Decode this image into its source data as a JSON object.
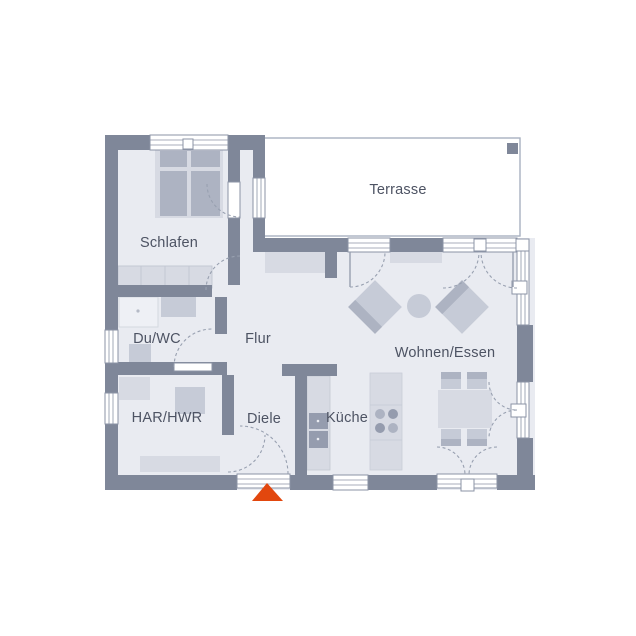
{
  "title": "Grundriss Erdgeschoss Bungalow",
  "rooms": {
    "schlafen": {
      "label": "Schlafen"
    },
    "terrasse": {
      "label": "Terrasse"
    },
    "duwc": {
      "label": "Du/WC"
    },
    "flur": {
      "label": "Flur"
    },
    "harhwr": {
      "label": "HAR/HWR"
    },
    "diele": {
      "label": "Diele"
    },
    "kueche": {
      "label": "Küche"
    },
    "wohnenessen": {
      "label": "Wohnen/Essen"
    }
  },
  "markers": {
    "entrance": "entrance-arrow"
  },
  "colors": {
    "wall": "#7f8799",
    "floor": "#e9ebf1",
    "terrace": "#ffffff",
    "furn-light": "#d7dae3",
    "furn-mid": "#c6cbd7",
    "furn-dark": "#adb3c2",
    "appliance": "#959cae",
    "outline": "#98a0b0",
    "frame": "#8b93a5",
    "text": "#4d5363",
    "accent": "#e2470e"
  }
}
